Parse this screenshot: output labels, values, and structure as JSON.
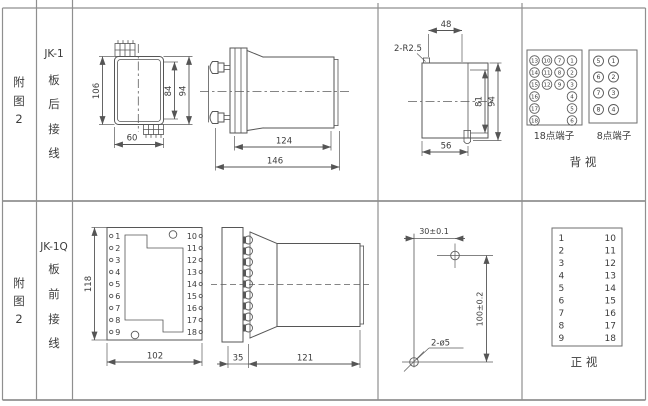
{
  "row1": {
    "fig": [
      "附",
      "图",
      "2"
    ],
    "model": "JK-1",
    "wiring": [
      "板",
      "后",
      "接",
      "线"
    ],
    "front_view": {
      "h": "106",
      "inner_h": "84",
      "outer_h": "94",
      "w": "60"
    },
    "side_view": {
      "depth": "124",
      "total": "146"
    },
    "top_view": {
      "note": "2-R2.5",
      "w48": "48",
      "h81": "81",
      "h94": "94",
      "w56": "56"
    },
    "t18": {
      "label": "18点端子",
      "rows": [
        [
          "13",
          "10",
          "7",
          "1"
        ],
        [
          "14",
          "11",
          "8",
          "2"
        ],
        [
          "15",
          "12",
          "9",
          "3"
        ],
        [
          "16",
          "",
          "",
          "4"
        ],
        [
          "17",
          "",
          "",
          "5"
        ],
        [
          "18",
          "",
          "",
          "6"
        ]
      ]
    },
    "t8": {
      "label": "8点端子",
      "rows": [
        [
          "5",
          "1"
        ],
        [
          "6",
          "2"
        ],
        [
          "7",
          "3"
        ],
        [
          "8",
          "4"
        ]
      ]
    },
    "view_label": "背  视"
  },
  "row2": {
    "fig": [
      "附",
      "图",
      "2"
    ],
    "model": "JK-1Q",
    "wiring": [
      "板",
      "前",
      "接",
      "线"
    ],
    "front_view": {
      "h": "118",
      "w": "102",
      "left": [
        "1",
        "2",
        "3",
        "4",
        "5",
        "6",
        "7",
        "8",
        "9"
      ],
      "right": [
        "10",
        "11",
        "12",
        "13",
        "14",
        "15",
        "16",
        "17",
        "18"
      ]
    },
    "side_view": {
      "plate": "35",
      "body": "121"
    },
    "drill_view": {
      "dx": "30±0.1",
      "dy": "100±0.2",
      "holes": "2-ø5"
    },
    "table": {
      "left": [
        "1",
        "2",
        "3",
        "4",
        "5",
        "6",
        "7",
        "8",
        "9"
      ],
      "right": [
        "10",
        "11",
        "12",
        "13",
        "14",
        "15",
        "16",
        "17",
        "18"
      ]
    },
    "view_label": "正  视"
  }
}
